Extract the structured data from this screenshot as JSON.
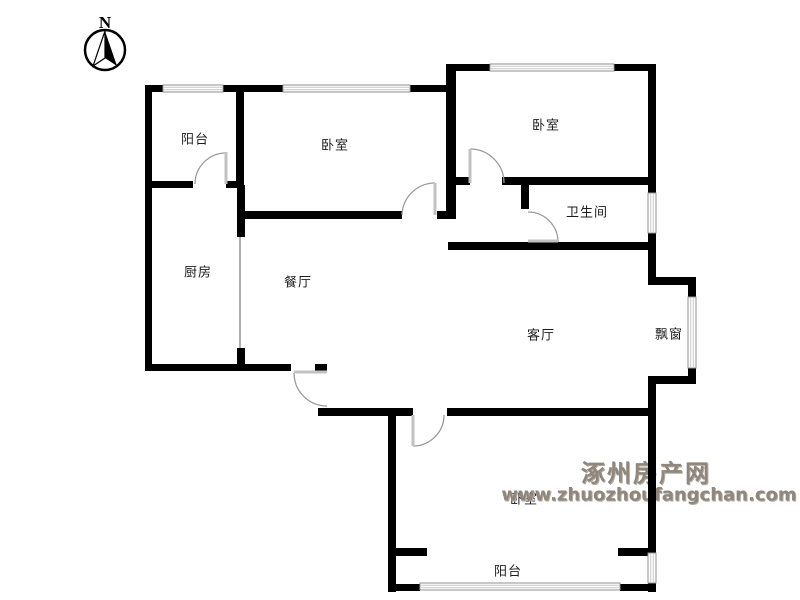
{
  "compass": {
    "label": "N"
  },
  "rooms": [
    {
      "id": "balcony-top",
      "label": "阳台"
    },
    {
      "id": "bedroom-top-middle",
      "label": "卧室"
    },
    {
      "id": "bedroom-top-right",
      "label": "卧室"
    },
    {
      "id": "bathroom",
      "label": "卫生间"
    },
    {
      "id": "kitchen",
      "label": "厨房"
    },
    {
      "id": "dining-room",
      "label": "餐厅"
    },
    {
      "id": "living-room",
      "label": "客厅"
    },
    {
      "id": "bay-window",
      "label": "飘窗"
    },
    {
      "id": "bedroom-bottom",
      "label": "卧室"
    },
    {
      "id": "balcony-bottom",
      "label": "阳台"
    }
  ],
  "watermark": {
    "site_name": "涿州房产网",
    "url": "www.zhuozhoufangchan.com",
    "color": "#8f867c"
  }
}
